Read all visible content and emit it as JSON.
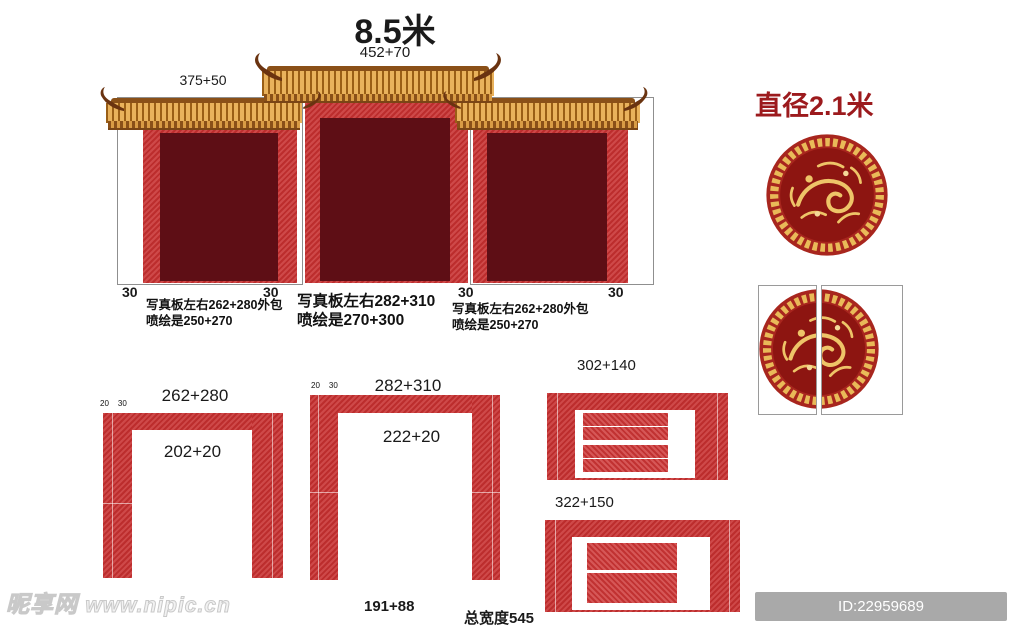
{
  "gate": {
    "width_label": "8.5米",
    "center_roof_label": "452+70",
    "left_roof_label": "375+50",
    "edge_labels": [
      "30",
      "30",
      "30",
      "30"
    ],
    "left_note_line1": "写真板左右262+280外包",
    "left_note_line2": "喷绘是250+270",
    "center_note_line1": "写真板左右282+310",
    "center_note_line2": "喷绘是270+300",
    "right_note_line1": "写真板左右262+280外包",
    "right_note_line2": "喷绘是250+270"
  },
  "medallion": {
    "diameter_label": "直径2.1米"
  },
  "frame_a": {
    "top_label": "262+280",
    "corner_labels": [
      "20",
      "30"
    ],
    "opening_label": "202+20"
  },
  "frame_b": {
    "top_label": "282+310",
    "corner_labels": [
      "20",
      "30"
    ],
    "opening_label": "222+20",
    "bottom_label": "191+88",
    "total_width_label": "总宽度545"
  },
  "banner_a": {
    "size_label": "302+140"
  },
  "banner_b": {
    "size_label": "322+150"
  },
  "watermark": {
    "site_name": "昵享网",
    "site_url": "www.nipic.cn"
  },
  "id_bar": {
    "text": "ID:22959689 NO:20241221142814270109"
  },
  "colors": {
    "panel_red": "#c93434",
    "panel_maroon": "#5e0e15",
    "roof_gold": "#e9b25c",
    "roof_stripe": "#9a5c14",
    "horn_brown": "#6a3310",
    "medallion_red": "#a8261e",
    "medallion_inner_red": "#8d1511",
    "medallion_gold": "#e9ba58",
    "diameter_text_red": "#9c1a1d",
    "id_bar_gray": "#a9a9a9"
  }
}
